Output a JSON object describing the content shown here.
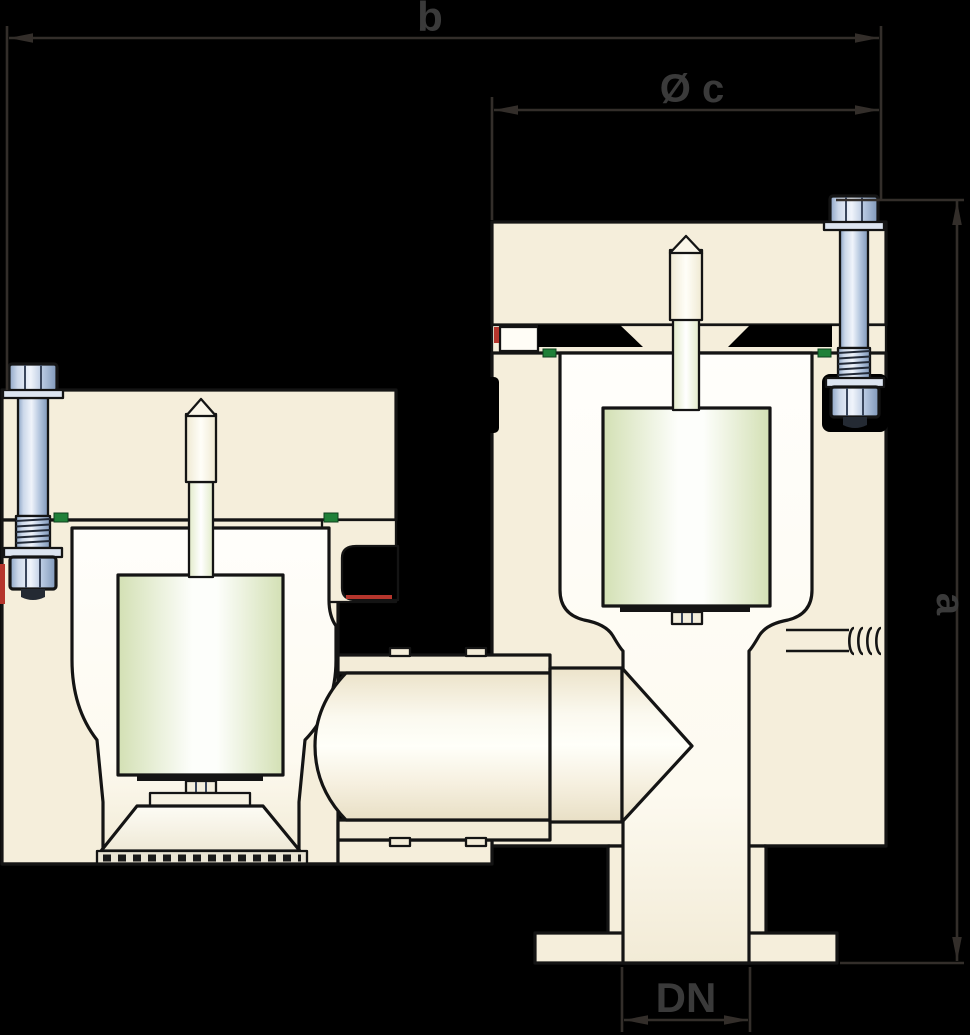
{
  "diagram": {
    "description": "Sectional technical drawing of a duplex change-over safety valve: two spring bonnets with pistons, a connecting pipe with pointed spindle, and a flanged bottom outlet, annotated with dimension lines",
    "labels": {
      "width": "b",
      "bonnet_diameter": "Ø c",
      "height": "a",
      "nominal_bore": "DN"
    }
  },
  "colors": {
    "background": "#000000",
    "outline": "#141414",
    "body_cream": "#f5eedb",
    "chamber_white": "#fffdf6",
    "piston_green": "#d6e3b8",
    "bolt_blue": "#b7c8e1",
    "seal_green": "#1f8038",
    "seal_red": "#b5352c",
    "dimension_line": "#332e2a",
    "label_text": "#3a3a3a"
  }
}
